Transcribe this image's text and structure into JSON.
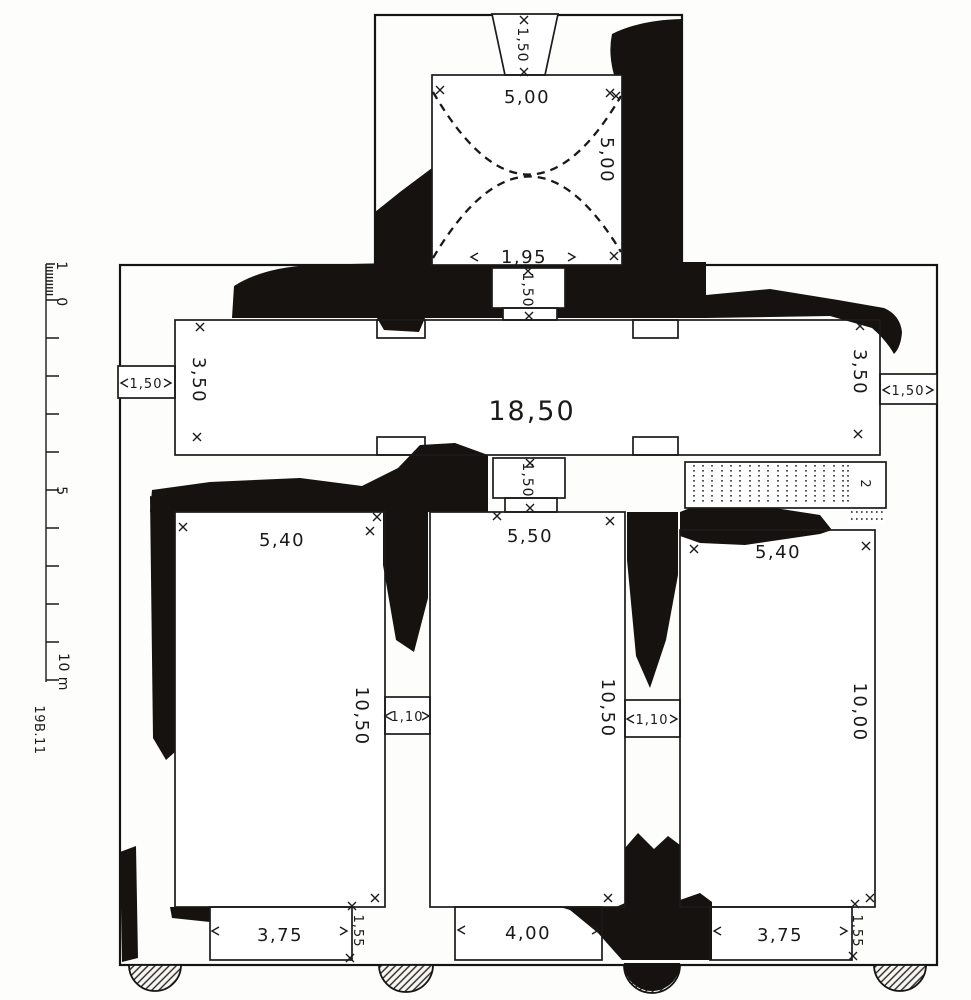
{
  "figure": {
    "type": "archaeological floor plan",
    "plate_mark": "19B.11",
    "colors": {
      "ink": "#1b1b1b",
      "ruin_fill": "#15120f",
      "paper": "#fdfdfb"
    }
  },
  "scale_bar": {
    "tick_1": "1",
    "tick_0": "0",
    "tick_5": "5",
    "tick_10": "10 m"
  },
  "dims": {
    "tower_width": "5,00",
    "tower_depth": "5,00",
    "tower_window": "1,50",
    "apse_span": "1,95",
    "tower_door": "1,50",
    "hall_length": "18,50",
    "hall_width_w": "3,50",
    "hall_width_e": "3,50",
    "hall_door_w": "1,50",
    "hall_door_e": "1,50",
    "hall_door_center": "1,50",
    "stair_width": "2",
    "room_w_width": "5,40",
    "room_w_length": "10,50",
    "room_w_entrance": "3,75",
    "room_w_entrance_depth": "1,55",
    "room_c_width": "5,50",
    "room_c_length": "10,50",
    "room_c_entrance": "4,00",
    "room_e_width": "5,40",
    "room_e_length": "10,00",
    "room_e_entrance": "3,75",
    "room_e_entrance_depth": "1,55",
    "door_w_c": "1,10",
    "door_c_e": "1,10"
  }
}
